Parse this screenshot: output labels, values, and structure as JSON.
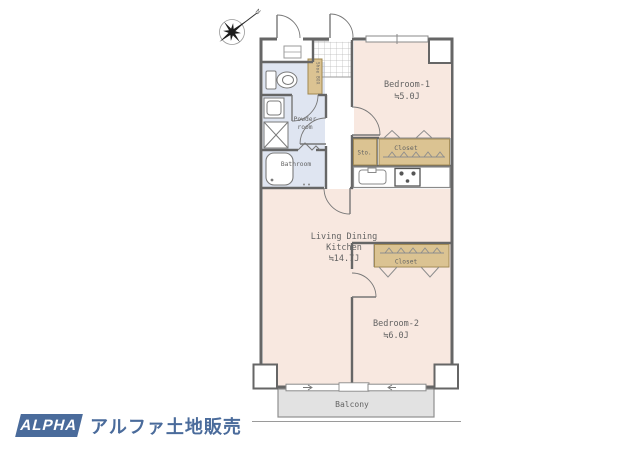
{
  "plan": {
    "compass": {
      "label": "N"
    },
    "rooms": {
      "bedroom1": {
        "name": "Bedroom-1",
        "size": "≒5.0J"
      },
      "bedroom2": {
        "name": "Bedroom-2",
        "size": "≒6.0J"
      },
      "ldk": {
        "line1": "Living Dining",
        "line2": "Kitchen",
        "size": "≒14.7J"
      },
      "powder_room": {
        "line1": "Powder",
        "line2": "room"
      },
      "bathroom": {
        "name": "Bathroom"
      },
      "balcony": {
        "name": "Balcony"
      }
    },
    "storage": {
      "sto": "Sto.",
      "closet_bedroom1": "Closet",
      "closet_bedroom2": "Closet",
      "shoe_box": "Shoe BOX"
    }
  },
  "footer": {
    "logo_badge": "ALPHA",
    "company_name": "アルファ土地販売"
  },
  "colors": {
    "room_fill": "#f8e8e0",
    "wet_area_fill": "#dfe5f1",
    "closet_fill": "#dbc392",
    "balcony_fill": "#e2e2e2",
    "wall": "#666666",
    "logo_blue": "#4a6b9b"
  }
}
